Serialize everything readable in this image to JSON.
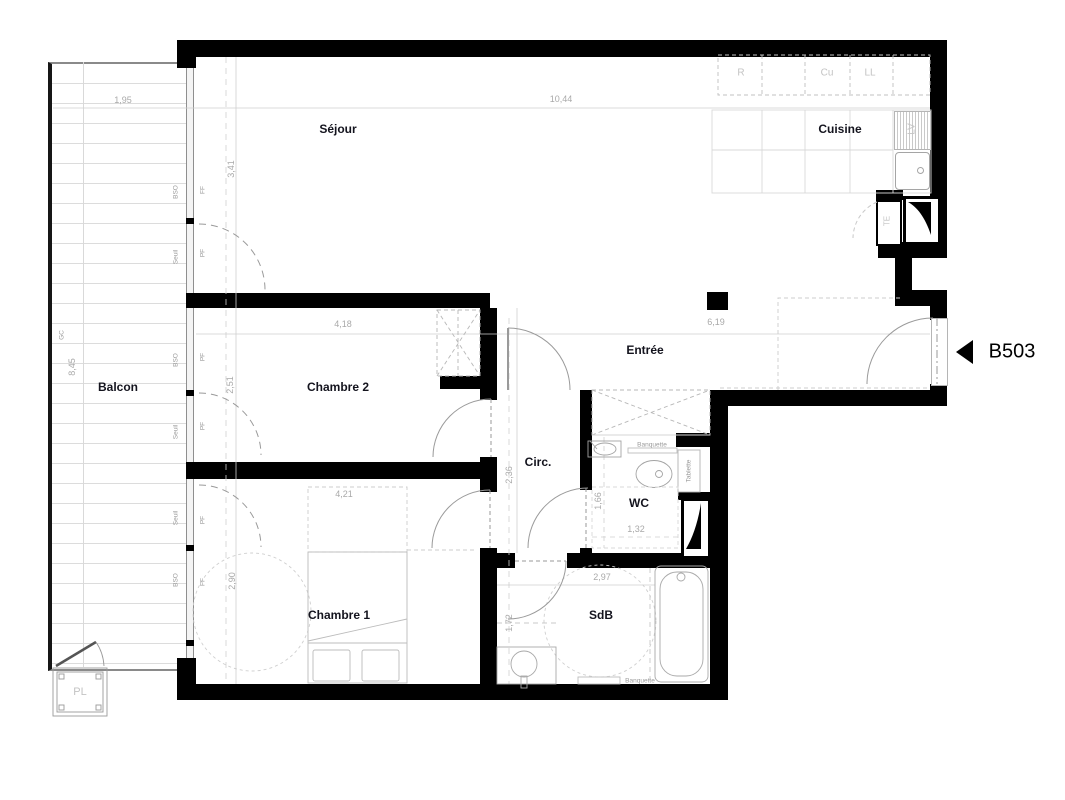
{
  "unit": {
    "label": "B503"
  },
  "rooms": {
    "sejour": "Séjour",
    "cuisine": "Cuisine",
    "balcon": "Balcon",
    "chambre2": "Chambre 2",
    "chambre1": "Chambre 1",
    "entree": "Entrée",
    "circ": "Circ.",
    "wc": "WC",
    "sdb": "SdB",
    "placard": "PL"
  },
  "dimensions": {
    "balcony_width": "1,95",
    "living_width": "10,44",
    "living_depth": "3,41",
    "balcony_length": "8,45",
    "chambre2_width": "4,18",
    "entree_width": "6,19",
    "chambre2_depth": "2,51",
    "bed_zone_width": "4,21",
    "chambre1_depth": "2,90",
    "circ_length": "2,36",
    "wc_depth": "1,66",
    "wc_width": "1,32",
    "sdb_width": "2,97",
    "sdb_depth": "1,72"
  },
  "kitchen": {
    "fridge": "R",
    "cooktop": "Cu",
    "washing_machine": "LL",
    "dishwasher": "LV",
    "electrical_panel": "TE"
  },
  "fittings": {
    "wc_bench": "Banquette",
    "wc_shelf": "Tablette",
    "sdb_bench": "Banquette"
  },
  "facade": {
    "guardrail": "GC",
    "balcony_side": [
      "BSO",
      "Seuil",
      "BSO",
      "Seuil",
      "Seuil",
      "BSO"
    ],
    "window_side": [
      "FF",
      "PF",
      "PF",
      "PF",
      "PF",
      "FF"
    ]
  }
}
